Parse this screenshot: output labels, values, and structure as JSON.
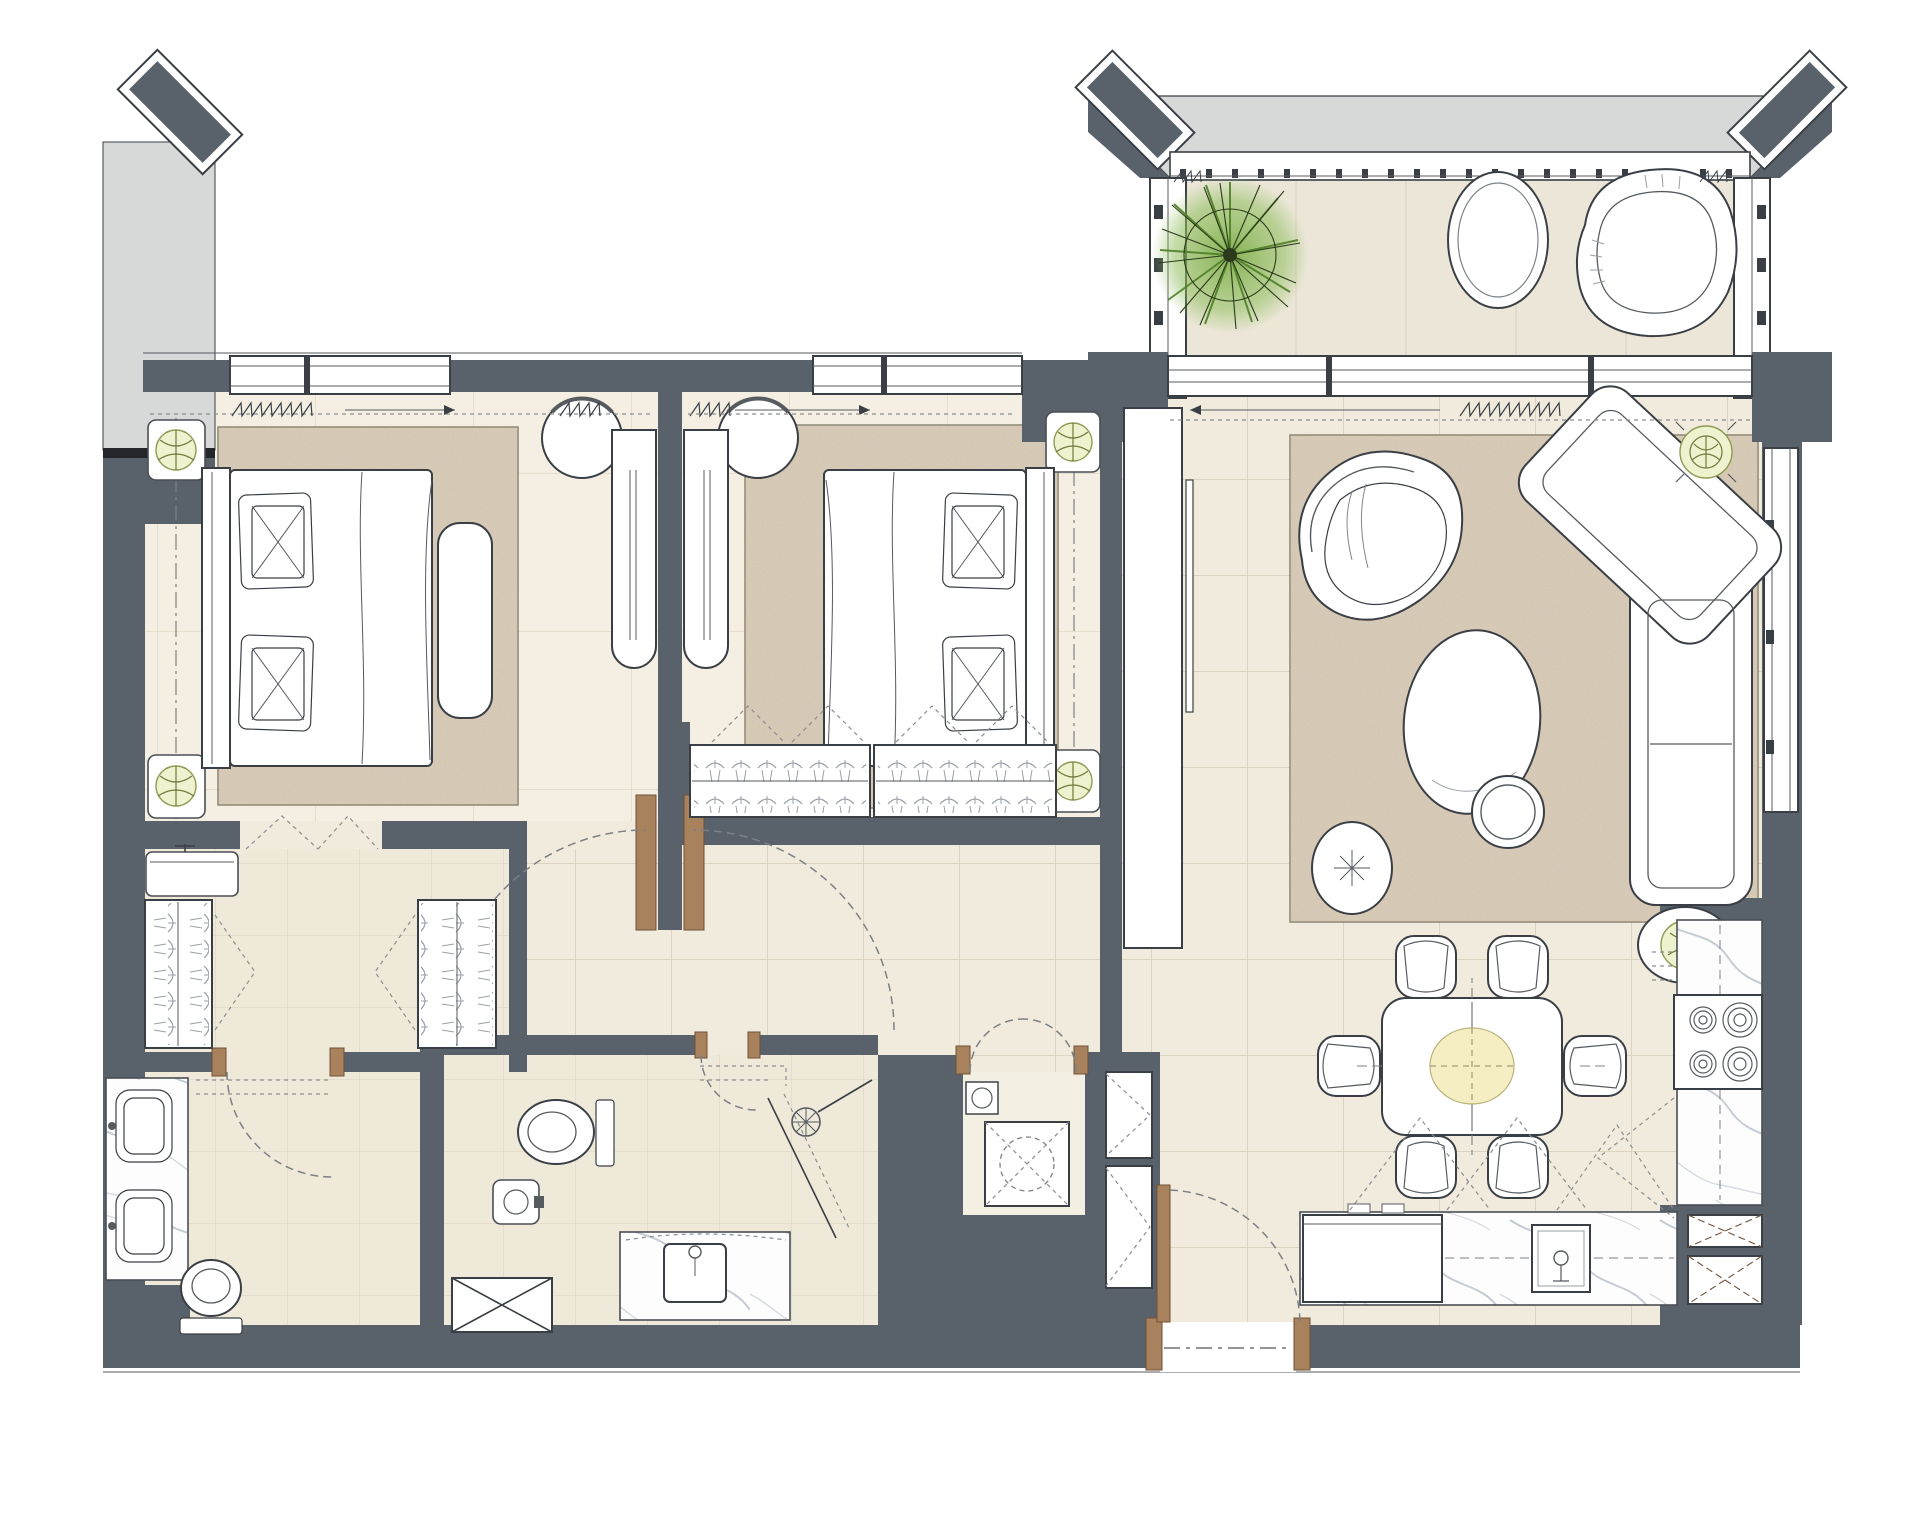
{
  "document": {
    "kind": "architectural-floor-plan",
    "description": "Rendered 2-bedroom apartment floor plan, top-down, no text labels",
    "visible_text": []
  },
  "colors": {
    "wall_dark": "#59616b",
    "wall_light_party": "#d7d8d8",
    "outline": "#3a3f45",
    "floor_main": "#f1ebdd",
    "floor_bedroom": "#f4efe2",
    "floor_bath": "#efe9da",
    "floor_balcony": "#ebe6d7",
    "tile_line": "#d5ccb8",
    "rug": "#d9ccb9",
    "door_wood": "#a8815d",
    "plant_green_dark": "#4f7f28",
    "plant_green_light": "#8fbe5d",
    "planter_accent": "#eef2cf",
    "dining_centerpiece": "#f4eec2",
    "marble_vein": "#c6ccd3",
    "swing_dash": "#7d8084"
  },
  "rooms": [
    {
      "id": "balcony",
      "furniture": [
        "potted-plant",
        "oval-side-table",
        "lounge-chair"
      ],
      "features": [
        "canopy-roof",
        "louvre-strip",
        "glazed-side-walls",
        "sliding-window-band"
      ]
    },
    {
      "id": "bedroom-1",
      "furniture": [
        "double-bed",
        "headboard",
        "pillows:2",
        "foot-bench",
        "nightstand:2",
        "nightstand-plant:2",
        "area-rug",
        "dressing-cabinet",
        "dressing-stool"
      ],
      "features": [
        "window",
        "curtain-symbol"
      ]
    },
    {
      "id": "bedroom-2",
      "furniture": [
        "double-bed",
        "headboard",
        "pillows:2",
        "nightstand:2",
        "nightstand-plant:2",
        "area-rug",
        "built-in-wardrobe-2-sections",
        "dressing-cabinet",
        "dressing-stool"
      ],
      "features": [
        "window",
        "curtain-symbol"
      ]
    },
    {
      "id": "walk-in-closet",
      "furniture": [
        "wardrobe-hanging:2",
        "utility-counter"
      ],
      "features": [
        "bifold-door-symbols"
      ]
    },
    {
      "id": "master-bathroom",
      "furniture": [
        "double-vanity",
        "basin:2",
        "toilet"
      ],
      "features": [
        "door-swing"
      ]
    },
    {
      "id": "bathroom-2",
      "furniture": [
        "toilet",
        "small-washbasin",
        "vanity-basin",
        "shower-head",
        "linen-cabinet"
      ],
      "features": [
        "door-swing",
        "glass-screen"
      ]
    },
    {
      "id": "laundry-closet",
      "furniture": [
        "washing-machine",
        "small-appliance"
      ],
      "features": [
        "double-door-swing"
      ]
    },
    {
      "id": "hallway",
      "furniture": [],
      "features": [
        "bedroom-door-swings"
      ]
    },
    {
      "id": "living-room",
      "furniture": [
        "armchair",
        "corner-sofa",
        "round-coffee-table",
        "round-side-table",
        "pouf",
        "plant-pot:2",
        "tv-unit",
        "tv"
      ],
      "features": [
        "area-rug",
        "side-window",
        "curtain-symbol"
      ]
    },
    {
      "id": "dining-area",
      "furniture": [
        "dining-table",
        "dining-chair:6",
        "table-centerpiece"
      ]
    },
    {
      "id": "kitchen",
      "furniture": [
        "tall-marble-counter",
        "cooktop-4-burners",
        "base-counter",
        "kitchen-sink",
        "storage-box-x:2",
        "upper-cabinet-dashed-symbols"
      ]
    },
    {
      "id": "entry",
      "furniture": [
        "entrance-door"
      ],
      "features": [
        "threshold",
        "door-swing"
      ]
    }
  ],
  "symbols": {
    "windows": 5,
    "door_swings": 8,
    "curtain_tracks": 3,
    "wardrobe_hanger_sections": 4,
    "x_marked_cabinets": 4
  },
  "canvas": {
    "width": 1918,
    "height": 1522
  }
}
